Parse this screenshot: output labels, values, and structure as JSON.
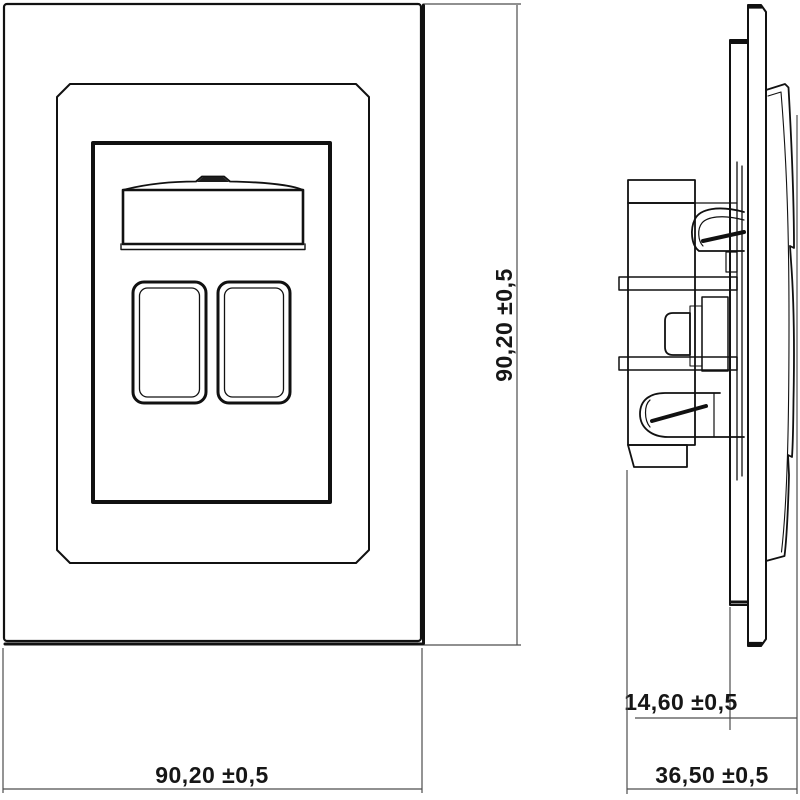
{
  "drawing": {
    "type": "technical-drawing",
    "subject": "wall-mounted multimedia socket outlet, front view and side view",
    "colors": {
      "background": "#ffffff",
      "outline": "#111111",
      "dimension_lines": "#4d4d4d",
      "dimension_text": "#161616"
    },
    "front_view": {
      "width_dim_label": "90,20 ±0,5",
      "height_dim_label": "90,20 ±0,5"
    },
    "side_view": {
      "front_depth_dim_label": "14,60 ±0,5",
      "total_depth_dim_label": "36,50 ±0,5"
    }
  }
}
